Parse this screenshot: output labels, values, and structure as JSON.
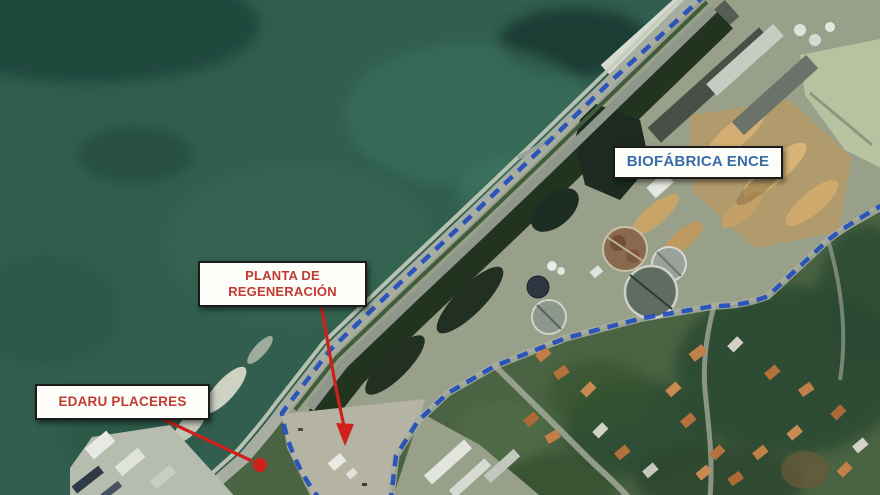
{
  "map": {
    "kind": "annotated-satellite-map",
    "labels": {
      "biofabrica": {
        "text": "BIOFÁBRICA ENCE",
        "text_color": "#3a6ca8"
      },
      "planta": {
        "text": "PLANTA DE REGENERACIÓN",
        "text_color": "#c23a31"
      },
      "edaru": {
        "text": "EDARU PLACERES",
        "text_color": "#c23a31"
      }
    },
    "annotations": {
      "label_box": {
        "background": "#fdfdfa",
        "border_color": "#1b1b1b"
      },
      "perimeter_line": {
        "style": "dashed",
        "color": "#2450bd"
      },
      "arrows": [
        {
          "name": "planta-arrow",
          "color": "#cf211b",
          "shape": "line-with-arrowhead"
        },
        {
          "name": "edaru-arrow",
          "color": "#cf211b",
          "shape": "line-with-dot"
        }
      ]
    },
    "features": [
      "sea",
      "coastal-road",
      "industrial-facility",
      "wastewater-tanks",
      "wood-chip-piles",
      "gravel-parcel",
      "hillside-housing",
      "wharf"
    ]
  }
}
